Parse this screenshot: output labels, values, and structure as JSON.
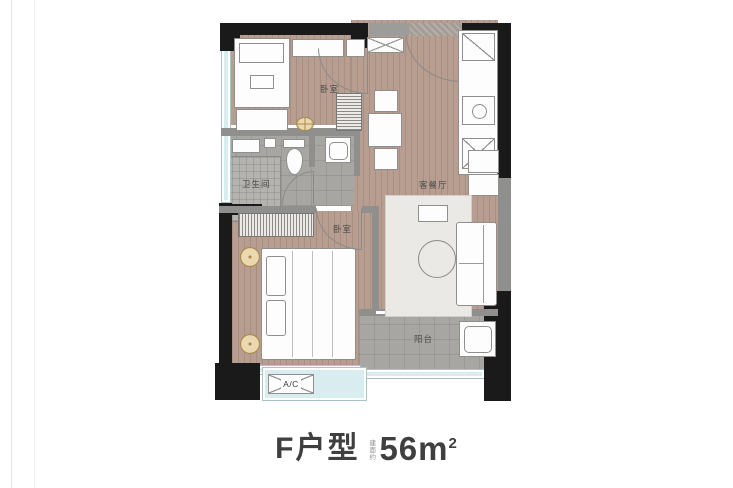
{
  "title": {
    "plan_name": "F户型",
    "area_note": "建面约",
    "area_number": "56",
    "area_unit": "m",
    "area_sup": "2"
  },
  "rooms": {
    "bedroom_top": {
      "label": "卧室"
    },
    "living_dining": {
      "label": "客餐厅"
    },
    "bathroom": {
      "label": "卫生间"
    },
    "bedroom_bottom": {
      "label": "卧室"
    },
    "balcony": {
      "label": "阳台"
    },
    "ac_platform": {
      "label": "A/C"
    }
  },
  "icons": {
    "entry_cabinet": "crossed-box",
    "fridge": "diagonal-box",
    "stove": "box-with-burner-circle",
    "sink": "crossed-box-with-faucet",
    "ceiling_light": "gold-circle-cross",
    "nightstand": "gold-circle",
    "ac_unit": "crossed-box",
    "washing_machine": "box-with-drum",
    "toilet": "tank-and-bowl",
    "washbasin": "box-with-basin"
  },
  "colors": {
    "wall_black": "#1a1a1a",
    "wall_gray": "#8f8f8d",
    "wood_floor": "#b79e90",
    "tile_floor": "#a7a6a2",
    "shower_tile": "#b4b3af",
    "window_glass": "#d9ecf0",
    "rug": "#ebe9e6",
    "furniture_fill": "#fdfdfd",
    "furniture_line": "#8f8f8d",
    "gold_accent": "#c9a96a",
    "title_text": "#3f3f3f",
    "label_text": "#4a4a4a",
    "entry_texture": "#a49d96"
  }
}
